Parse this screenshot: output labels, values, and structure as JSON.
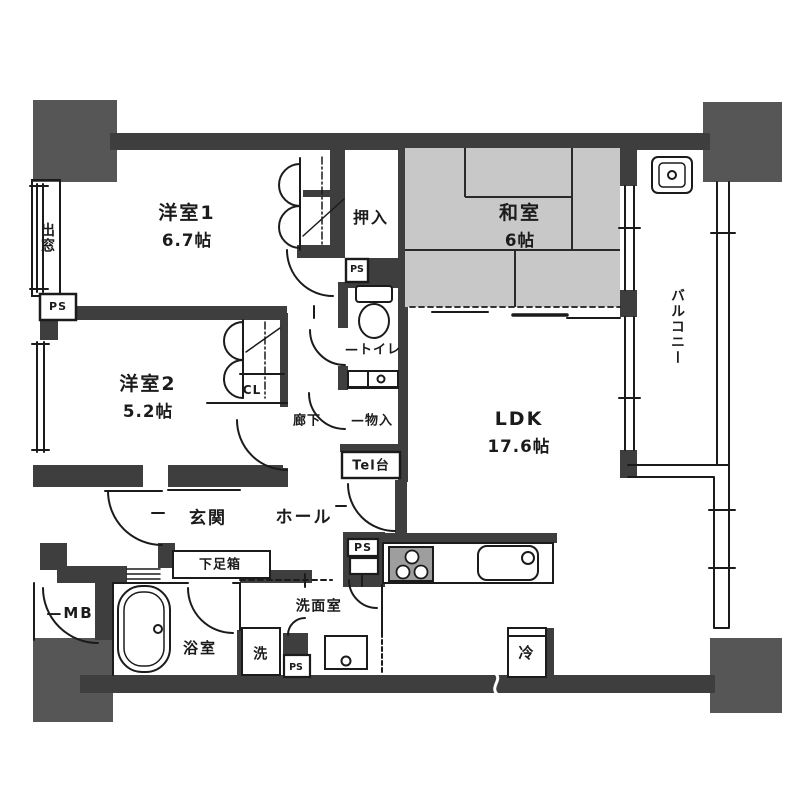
{
  "plan": {
    "rooms": {
      "yoshitsu1": {
        "name": "洋室1",
        "size": "6.7帖"
      },
      "yoshitsu2": {
        "name": "洋室2",
        "size": "5.2帖"
      },
      "washitsu": {
        "name": "和室",
        "size": "6帖"
      },
      "ldk": {
        "name": "LDK",
        "size": "17.6帖"
      }
    },
    "labels": {
      "demado": "出窓",
      "ps": "PS",
      "oshiire": "押入",
      "toilet": "—トイレ",
      "rouka": "廊下",
      "monoire": "—物入",
      "teldai": "Tel台",
      "cl": "CL",
      "balcony": "バルコニー",
      "genkan": "玄関",
      "hall": "ホール",
      "getabako": "下足箱",
      "mb": "—MB",
      "bath": "浴室",
      "laundry": "洗",
      "senmen": "洗面室",
      "fridge": "冷"
    },
    "fixtures": [
      "toilet",
      "bathtub",
      "washbasin",
      "kitchen-sink",
      "stove",
      "refrigerator",
      "slop-sink",
      "shoe-box",
      "tel-stand",
      "meter-box"
    ],
    "colors": {
      "wall": "#3e3e3e",
      "column": "#565656",
      "tatami": "#c8c8c8",
      "line": "#1b1b1b",
      "stove": "#9e9e9e",
      "background": "#ffffff"
    }
  }
}
